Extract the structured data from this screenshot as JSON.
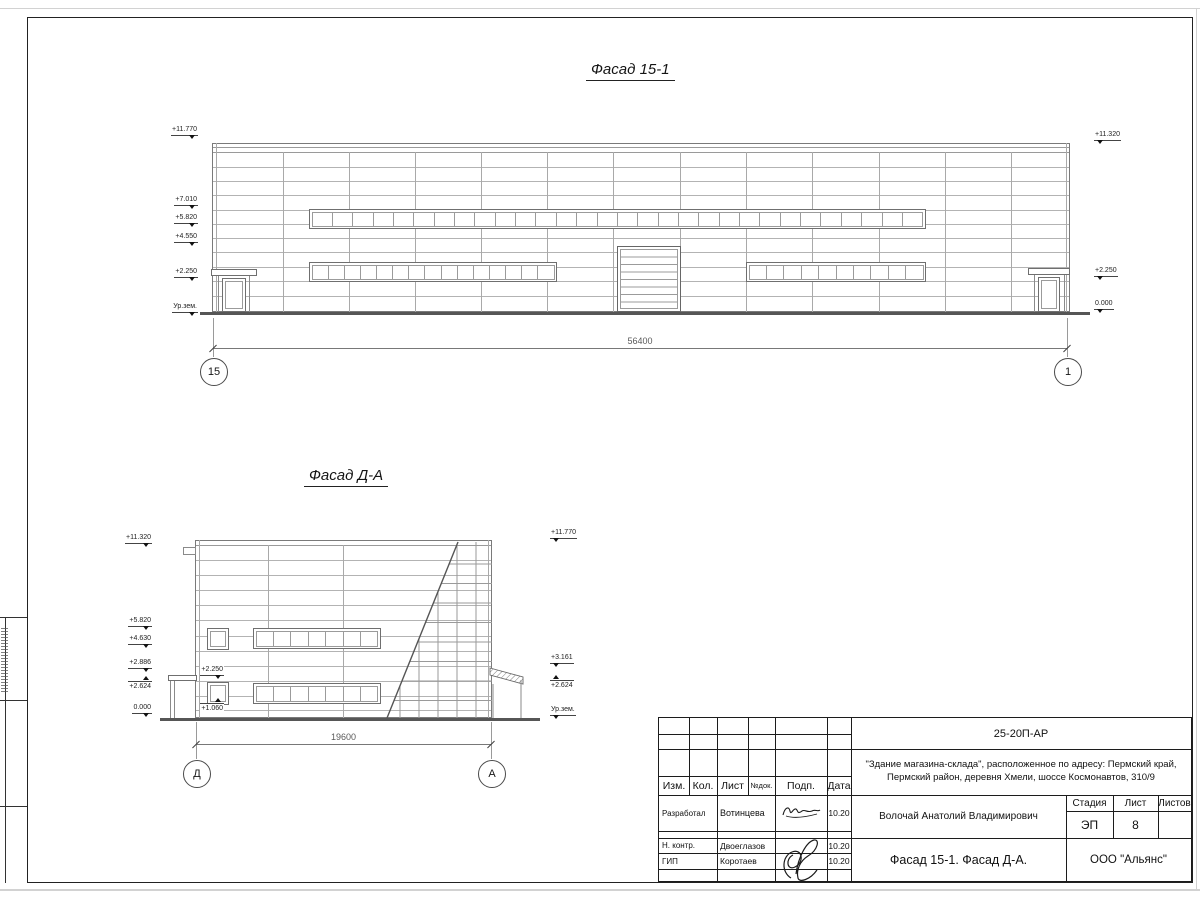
{
  "facade1": {
    "title": "Фасад 15-1",
    "dimension": "56400",
    "axis_left": "15",
    "axis_right": "1",
    "marks_left": [
      {
        "label": "+11.770",
        "y": 126
      },
      {
        "label": "+7.010",
        "y": 196
      },
      {
        "label": "+5.820",
        "y": 214
      },
      {
        "label": "+4.550",
        "y": 233
      },
      {
        "label": "+2.250",
        "y": 268
      },
      {
        "label": "Ур.зем.",
        "y": 303
      }
    ],
    "marks_right": [
      {
        "label": "+11.320",
        "y": 131
      },
      {
        "label": "+2.250",
        "y": 267
      },
      {
        "label": "0.000",
        "y": 300
      }
    ],
    "bands": [
      {
        "x": 309,
        "y": 209,
        "w": 617,
        "h": 20,
        "panes": 30
      },
      {
        "x": 309,
        "y": 262,
        "w": 248,
        "h": 20,
        "panes": 15
      },
      {
        "x": 746,
        "y": 262,
        "w": 180,
        "h": 20,
        "panes": 10
      }
    ]
  },
  "facade2": {
    "title": "Фасад Д-А",
    "dimension": "19600",
    "axis_left": "Д",
    "axis_right": "А",
    "marks_left": [
      {
        "label": "+11.320",
        "y": 534
      },
      {
        "label": "+5.820",
        "y": 617
      },
      {
        "label": "+4.630",
        "y": 635
      },
      {
        "label": "+2.886",
        "y": 659
      },
      {
        "label": "+2.624",
        "y": 681,
        "up": true
      },
      {
        "label": "0.000",
        "y": 704
      }
    ],
    "marks_right": [
      {
        "label": "+11.770",
        "y": 529
      },
      {
        "label": "+3.161",
        "y": 654
      },
      {
        "label": "+2.624",
        "y": 680,
        "up": true
      },
      {
        "label": "Ур.зем.",
        "y": 706
      }
    ],
    "marks_inner": [
      {
        "label": "+2.250",
        "x": 172,
        "y": 666
      },
      {
        "label": "+1.060",
        "x": 172,
        "y": 703,
        "up": true
      }
    ],
    "bands": [
      {
        "x": 253,
        "y": 628,
        "w": 128,
        "h": 21,
        "panes": 7
      },
      {
        "x": 253,
        "y": 683,
        "w": 128,
        "h": 21,
        "panes": 7
      }
    ]
  },
  "titleblock": {
    "doc_number": "25-20П-АР",
    "object_line1": "\"Здание магазина-склада\", расположенное по адресу: Пермский край,",
    "object_line2": "Пермский район, деревня Хмели, шоссе Космонавтов, 310/9",
    "col_izm": "Изм.",
    "col_kol": "Кол.",
    "col_list": "Лист",
    "col_ndok": "№док.",
    "col_podp": "Подп.",
    "col_data": "Дата",
    "rows": [
      {
        "role": "Разработал",
        "name": "Вотинцева",
        "date": "10.20"
      },
      {
        "role": "Н. контр.",
        "name": "Двоеглазов",
        "date": "10.20"
      },
      {
        "role": "ГИП",
        "name": "Коротаев",
        "date": "10.20"
      }
    ],
    "chief_name": "Волочай Анатолий Владимирович",
    "stage_label": "Стадия",
    "sheet_label": "Лист",
    "sheets_label": "Листов",
    "stage_value": "ЭП",
    "sheet_value": "8",
    "sheets_value": "",
    "drawing_name": "Фасад 15-1. Фасад Д-А.",
    "company": "ООО \"Альянс\""
  }
}
